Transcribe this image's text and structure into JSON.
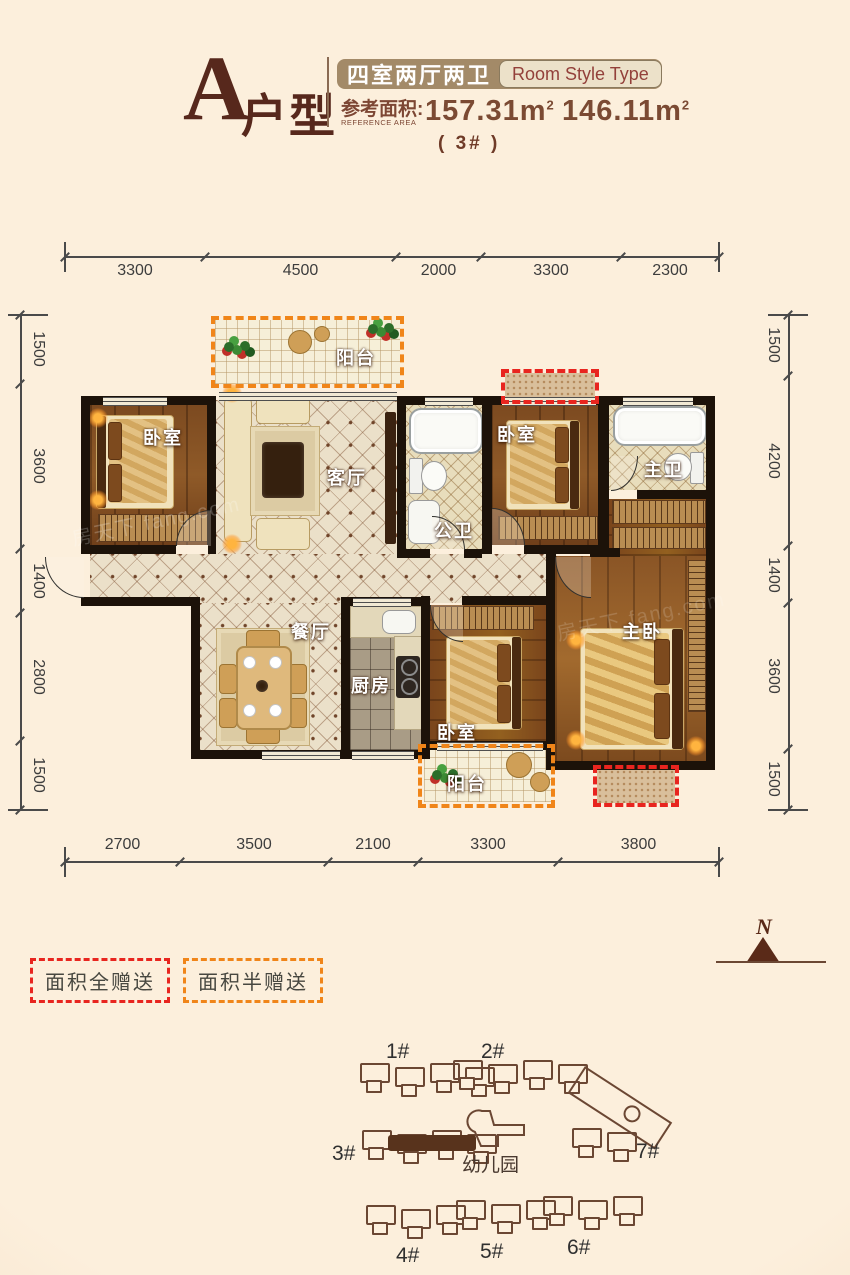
{
  "header": {
    "letter": "A",
    "suffix": "户型",
    "badge_cn": "四室两厅两卫",
    "badge_en": "Room Style Type",
    "area_label_cn": "参考面积:",
    "area_label_en": "REFERENCE AREA",
    "area1": "157.31",
    "area2": "146.11",
    "unit": "m",
    "sup": "2",
    "note": "( 3# )"
  },
  "dimensions": {
    "top": [
      "3300",
      "4500",
      "2000",
      "3300",
      "2300"
    ],
    "bottom": [
      "2700",
      "3500",
      "2100",
      "3300",
      "3800"
    ],
    "left": [
      "1500",
      "3600",
      "1400",
      "2800",
      "1500"
    ],
    "right": [
      "1500",
      "4200",
      "1400",
      "3600",
      "1500"
    ]
  },
  "rooms": {
    "balcony_top": "阳台",
    "bedroom_tl": "卧室",
    "living": "客厅",
    "bath_public": "公卫",
    "bedroom_tm": "卧室",
    "bath_master": "主卫",
    "dining": "餐厅",
    "kitchen": "厨房",
    "bedroom_b": "卧室",
    "master": "主卧",
    "balcony_bottom": "阳台"
  },
  "legend": {
    "full": "面积全赠送",
    "half": "面积半赠送"
  },
  "compass": {
    "n": "N"
  },
  "site": {
    "labels": [
      "1#",
      "2#",
      "3#",
      "幼儿园",
      "7#",
      "4#",
      "5#",
      "6#"
    ]
  },
  "watermark": {
    "text": "房天下 fang.com"
  },
  "colors": {
    "accent_red": "#e8251f",
    "accent_orange": "#f08519",
    "maroon": "#57281c",
    "badge_tan": "#a38a68",
    "background": "#fcefdc",
    "wall": "#1c1209"
  }
}
